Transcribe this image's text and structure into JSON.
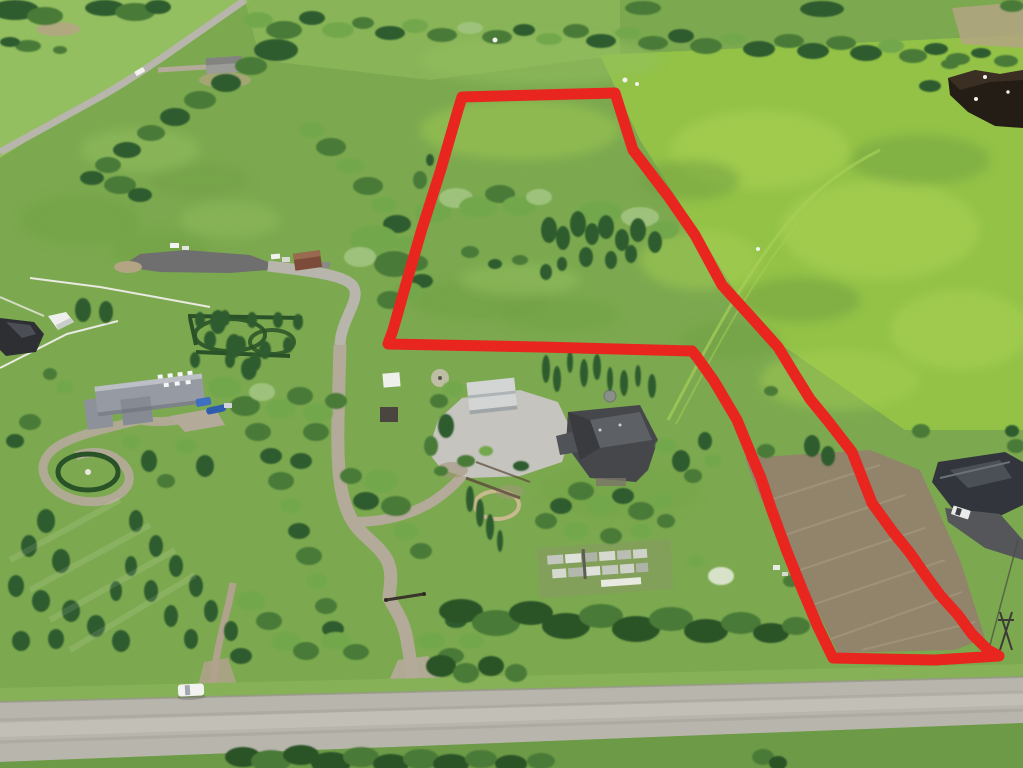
{
  "scene": {
    "type": "aerial-drone-photograph",
    "subject": "rural acreage with red property boundary outline drawn over pasture",
    "features": [
      "red outlined parcel: wide trapezoid at top connected by narrow strip to lower-right field",
      "tree grove inside outlined parcel",
      "central homestead with dark-roof house, white garage, gardens and garden boxes",
      "west neighbor acreage with large gray-roof house, oval hedge and circular driveway",
      "cul-de-sac road with brown-roof house at mid-left",
      "diagonal rural road at top-left with white vehicle",
      "gravel range road across bottom with white car",
      "dark-roof neighbor house with asphalt driveway at right edge",
      "dark pond at top-right corner",
      "brown cultivated strip inside lower-right of boundary"
    ]
  },
  "palette": {
    "boundary_red": "#e8251f",
    "field_base": "#7ca94f",
    "field_light": "#94bf60",
    "field_bright": "#93c247",
    "field_bright_hi": "#a9d153",
    "field_dark_streak": "#6f9e41",
    "pasture_left": "#7aa64e",
    "road_gravel": "#b7b5ac",
    "road_dark_asphalt": "#6f6f6f",
    "driveway_gravel": "#b3aa99",
    "dirt_patch": "#b3a583",
    "brown_field": "#91846a",
    "brown_field_light": "#a3957c",
    "tree_dark": "#2e5c2e",
    "tree_mid": "#4a7a38",
    "tree_light": "#73a74c",
    "tree_pale": "#9ec27b",
    "hedge_dark": "#2a5228",
    "pond_dark": "#241d16",
    "house_gray_roof": "#969ba3",
    "house_dark_roof": "#45474b",
    "house_black_roof": "#32363c",
    "house_brown_roof": "#7d4b39",
    "garage_white_roof": "#d2d5d4",
    "white": "#f2f3f0",
    "blue_accent": "#3f6fc0",
    "fence_white": "#e9eae2",
    "asphalt_drive": "#55565a",
    "verge_green": "#86b156",
    "grass_below_road": "#6d9a46"
  },
  "boundary": {
    "stroke_width": 11,
    "points": [
      [
        462,
        97
      ],
      [
        615,
        93
      ],
      [
        633,
        150
      ],
      [
        668,
        196
      ],
      [
        695,
        235
      ],
      [
        722,
        285
      ],
      [
        752,
        318
      ],
      [
        778,
        347
      ],
      [
        792,
        370
      ],
      [
        810,
        399
      ],
      [
        828,
        421
      ],
      [
        852,
        452
      ],
      [
        872,
        503
      ],
      [
        893,
        532
      ],
      [
        910,
        553
      ],
      [
        926,
        576
      ],
      [
        940,
        595
      ],
      [
        958,
        615
      ],
      [
        972,
        634
      ],
      [
        988,
        650
      ],
      [
        999,
        656
      ],
      [
        935,
        660
      ],
      [
        833,
        658
      ],
      [
        818,
        627
      ],
      [
        802,
        589
      ],
      [
        786,
        549
      ],
      [
        771,
        508
      ],
      [
        761,
        478
      ],
      [
        753,
        459
      ],
      [
        737,
        420
      ],
      [
        714,
        381
      ],
      [
        697,
        357
      ],
      [
        692,
        351
      ],
      [
        540,
        347
      ],
      [
        388,
        344
      ],
      [
        393,
        330
      ],
      [
        404,
        291
      ],
      [
        421,
        232
      ],
      [
        441,
        169
      ],
      [
        458,
        110
      ]
    ]
  }
}
